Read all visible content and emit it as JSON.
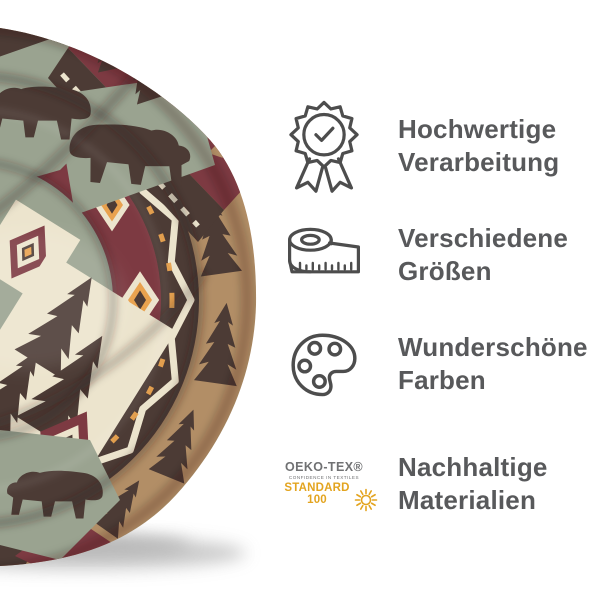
{
  "canvas": {
    "width": 600,
    "height": 600,
    "background": "#ffffff"
  },
  "product": {
    "label": "Round rolled blanket with southwestern bear, pine tree and aztec diamond pattern",
    "palette": {
      "sage": "#9aa390",
      "dark_brown": "#4c3b35",
      "maroon": "#7d3a42",
      "cream": "#ece4cd",
      "tan": "#b28e66",
      "orange": "#e9a24e"
    }
  },
  "features": [
    {
      "icon": "award-badge-icon",
      "line1": "Hochwertige",
      "line2": "Verarbeitung"
    },
    {
      "icon": "measuring-tape-icon",
      "line1": "Verschiedene",
      "line2": "Größen"
    },
    {
      "icon": "paint-palette-icon",
      "line1": "Wunderschöne",
      "line2": "Farben"
    },
    {
      "icon": "oeko-tex-label",
      "line1": "Nachhaltige",
      "line2": "Materialien"
    }
  ],
  "oeko_tex": {
    "brand": "OEKO-TEX®",
    "tagline": "CONFIDENCE IN TEXTILES",
    "standard": "STANDARD 100",
    "gold": "#e3a41f",
    "gray": "#707173"
  },
  "style": {
    "text_color": "#58595b",
    "icon_color": "#4d4d4d"
  }
}
